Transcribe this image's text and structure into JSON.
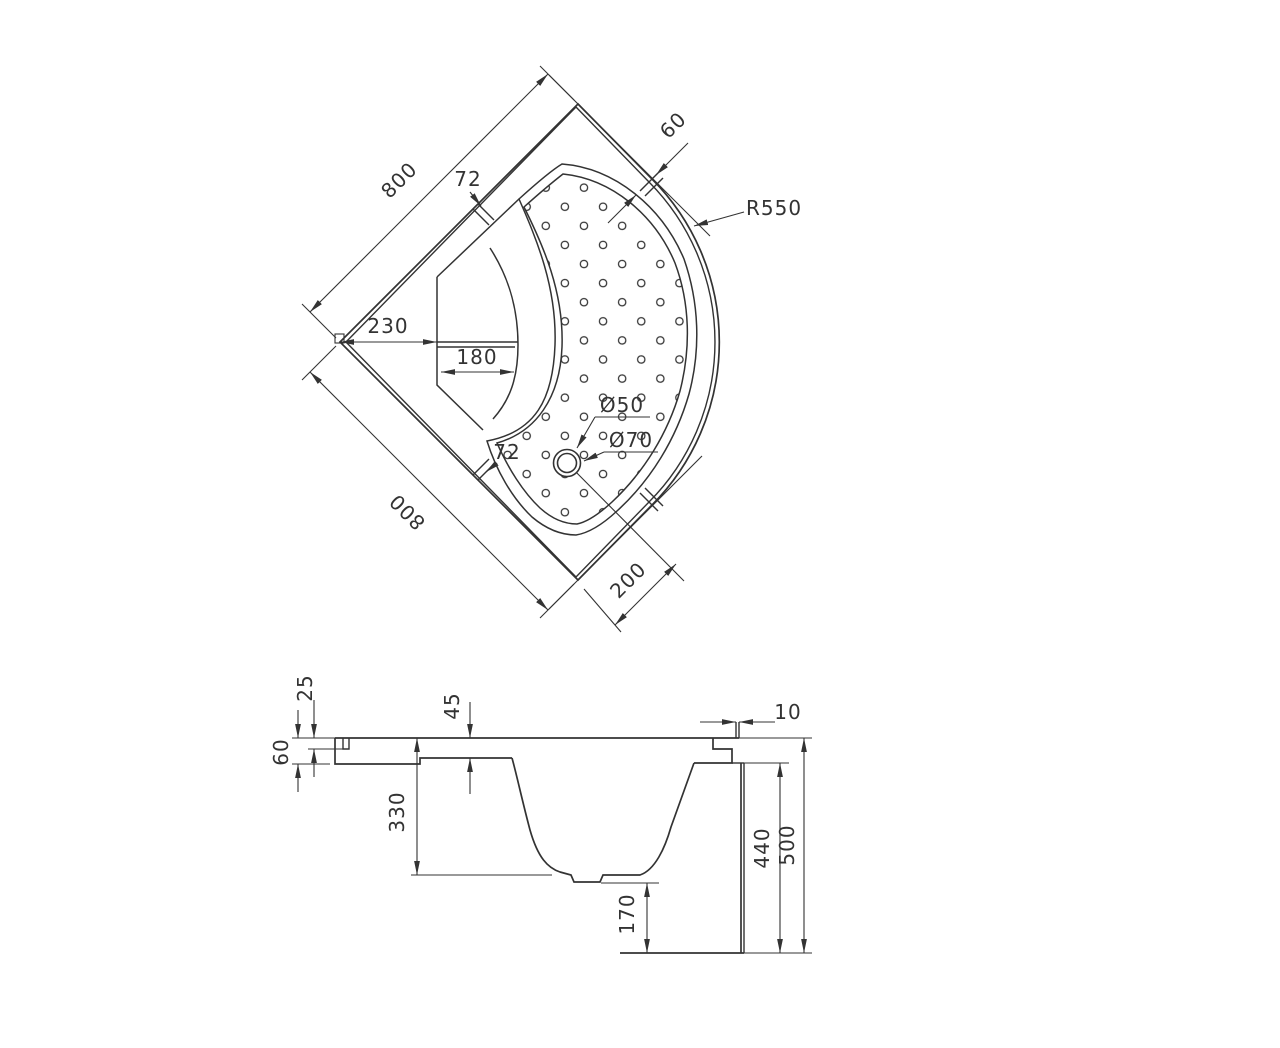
{
  "page": {
    "background": "#ffffff",
    "line_color": "#333333",
    "description": "Technical drawing of quadrant corner shower tray, plan view and sectional elevation"
  },
  "top_view": {
    "dim_side_top": "800",
    "dim_side_bottom": "800",
    "dim_corner_to_seat": "230",
    "dim_seat_depth": "180",
    "dim_rim_width_top": "72",
    "dim_rim_width_bottom": "72",
    "dim_rim_width_arc": "60",
    "dim_front_cut": "200",
    "dim_front_radius": "R550",
    "dim_drain_hole": "Ø50",
    "dim_drain_flange": "Ø70"
  },
  "section_view": {
    "dim_rim_step": "25",
    "dim_seat_recess": "45",
    "dim_rim_height": "60",
    "dim_basin_depth": "330",
    "dim_base_clearance": "170",
    "dim_apron_height": "440",
    "dim_total_height": "500",
    "dim_upstand_width": "10"
  }
}
